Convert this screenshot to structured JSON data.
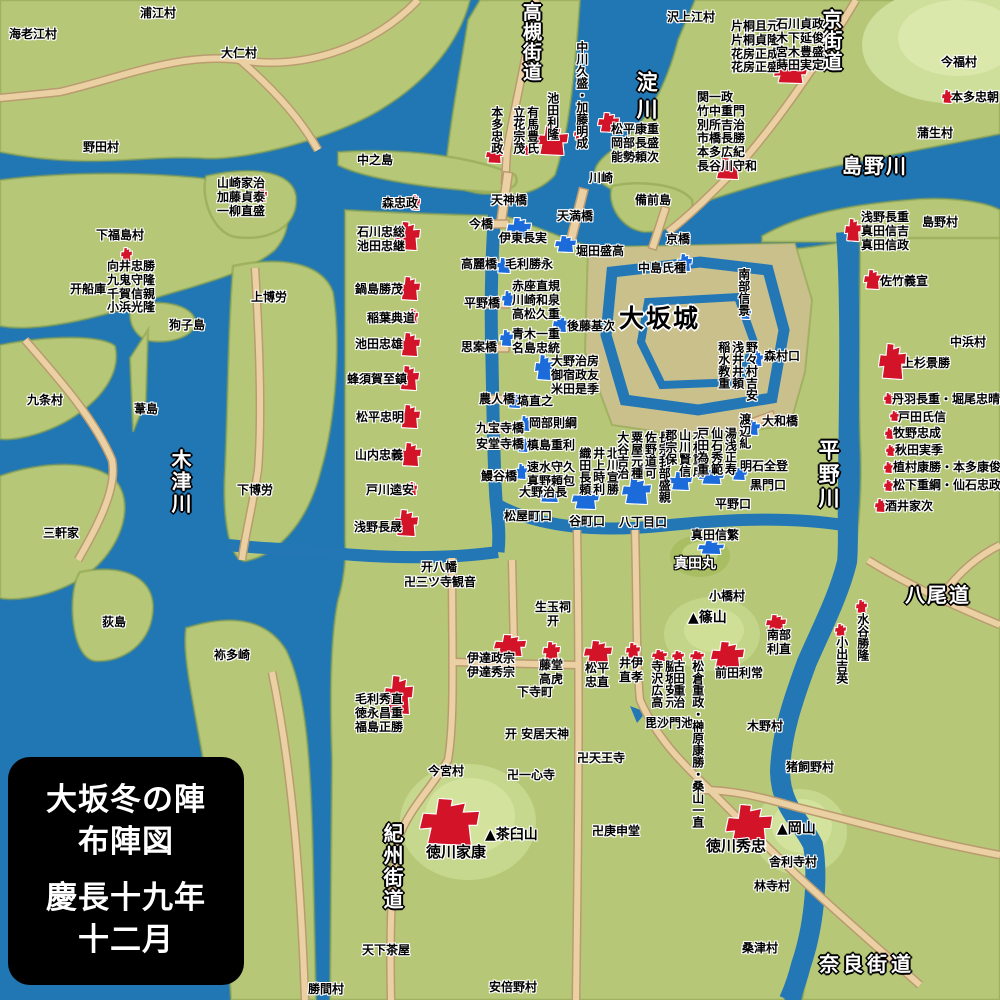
{
  "legend": {
    "l1": "大坂冬の陣",
    "l2": "布陣図",
    "l3": "慶長十九年",
    "l4": "十二月"
  },
  "colors": {
    "east_red": "#d31428",
    "west_blue": "#1b6bdb",
    "water": "#2176b4",
    "land": "#b6c878",
    "road": "#ead0a2",
    "hill": "#cede9b"
  },
  "map": {
    "big_labels": [
      {
        "t": "高槻街道",
        "x": 519,
        "y": 2,
        "v": 1,
        "fs": 19,
        "ls": 1
      },
      {
        "t": "淀川",
        "x": 634,
        "y": 71,
        "v": 1,
        "fs": 21,
        "ls": 6
      },
      {
        "t": "京街道",
        "x": 819,
        "y": 9,
        "v": 1,
        "fs": 20,
        "ls": 1
      },
      {
        "t": "島野川",
        "x": 842,
        "y": 155,
        "fs": 20,
        "ls": 2
      },
      {
        "t": "木津川",
        "x": 168,
        "y": 449,
        "v": 1,
        "fs": 20,
        "ls": 2
      },
      {
        "t": "平野川",
        "x": 816,
        "y": 439,
        "v": 1,
        "fs": 21,
        "ls": 3
      },
      {
        "t": "八尾道",
        "x": 905,
        "y": 584,
        "fs": 20,
        "ls": 2
      },
      {
        "t": "紀州街道",
        "x": 380,
        "y": 823,
        "v": 1,
        "fs": 20,
        "ls": 2
      },
      {
        "t": "奈良街道",
        "x": 819,
        "y": 953,
        "fs": 20,
        "ls": 4
      }
    ],
    "castle_label": {
      "t": "大坂城",
      "x": 619,
      "y": 305,
      "fs": 25,
      "ls": 2
    },
    "sanada_label": {
      "t": "真田丸",
      "x": 674,
      "y": 556
    },
    "villages": [
      {
        "t": "浦江村",
        "x": 140,
        "y": 7
      },
      {
        "t": "海老江村",
        "x": 9,
        "y": 28
      },
      {
        "t": "大仁村",
        "x": 221,
        "y": 47
      },
      {
        "t": "野田村",
        "x": 83,
        "y": 141
      },
      {
        "t": "中之島",
        "x": 357,
        "y": 154
      },
      {
        "t": "下福島村",
        "x": 96,
        "y": 229
      },
      {
        "t": "上博労",
        "x": 251,
        "y": 291
      },
      {
        "t": "狗子島",
        "x": 169,
        "y": 319
      },
      {
        "t": "九条村",
        "x": 27,
        "y": 394
      },
      {
        "t": "葦島",
        "x": 134,
        "y": 403
      },
      {
        "t": "下博労",
        "x": 237,
        "y": 484
      },
      {
        "t": "三軒家",
        "x": 43,
        "y": 527
      },
      {
        "t": "荻島",
        "x": 102,
        "y": 616
      },
      {
        "t": "袮多崎",
        "x": 214,
        "y": 649
      },
      {
        "t": "川崎",
        "x": 589,
        "y": 172
      },
      {
        "t": "備前島",
        "x": 635,
        "y": 194
      },
      {
        "t": "沢上江村",
        "x": 667,
        "y": 11
      },
      {
        "t": "今福村",
        "x": 941,
        "y": 56
      },
      {
        "t": "蒲生村",
        "x": 917,
        "y": 127
      },
      {
        "t": "島野村",
        "x": 922,
        "y": 216
      },
      {
        "t": "中浜村",
        "x": 950,
        "y": 336
      },
      {
        "t": "小橋村",
        "x": 709,
        "y": 590
      },
      {
        "t": "木野村",
        "x": 747,
        "y": 720
      },
      {
        "t": "猪飼野村",
        "x": 786,
        "y": 761
      },
      {
        "t": "今宮村",
        "x": 428,
        "y": 765
      },
      {
        "t": "下寺町",
        "x": 517,
        "y": 686
      },
      {
        "t": "舎利寺村",
        "x": 769,
        "y": 856
      },
      {
        "t": "林寺村",
        "x": 754,
        "y": 880
      },
      {
        "t": "桑津村",
        "x": 742,
        "y": 942
      },
      {
        "t": "天下茶屋",
        "x": 362,
        "y": 944
      },
      {
        "t": "勝間村",
        "x": 308,
        "y": 983
      },
      {
        "t": "安倍野村",
        "x": 489,
        "y": 981
      }
    ],
    "bridges": [
      {
        "t": "天神橋",
        "x": 491,
        "y": 194
      },
      {
        "t": "今橋",
        "x": 469,
        "y": 218
      },
      {
        "t": "天満橋",
        "x": 557,
        "y": 210
      },
      {
        "t": "京橋",
        "x": 666,
        "y": 233
      },
      {
        "t": "高麗橋",
        "x": 461,
        "y": 258
      },
      {
        "t": "平野橋",
        "x": 464,
        "y": 297
      },
      {
        "t": "思案橋",
        "x": 461,
        "y": 341
      },
      {
        "t": "農人橋",
        "x": 479,
        "y": 393
      },
      {
        "t": "九宝寺橋",
        "x": 476,
        "y": 422
      },
      {
        "t": "安堂寺橋",
        "x": 476,
        "y": 438
      },
      {
        "t": "鰻谷橋",
        "x": 481,
        "y": 470
      },
      {
        "t": "大和橋",
        "x": 762,
        "y": 415
      }
    ],
    "gates": [
      {
        "t": "松屋町口",
        "x": 504,
        "y": 510
      },
      {
        "t": "谷町口",
        "x": 569,
        "y": 515
      },
      {
        "t": "八丁目口",
        "x": 619,
        "y": 516
      },
      {
        "t": "平野口",
        "x": 715,
        "y": 498
      },
      {
        "t": "黒門口",
        "x": 750,
        "y": 479
      },
      {
        "t": "森村口",
        "x": 764,
        "y": 350
      }
    ],
    "landmarks": [
      {
        "t": "开八幡",
        "x": 421,
        "y": 561
      },
      {
        "t": "卍三ツ寺観音",
        "x": 404,
        "y": 576
      },
      {
        "t": [
          "生玉祠",
          "　开"
        ],
        "x": 535,
        "y": 601
      },
      {
        "t": "开 安居天神",
        "x": 505,
        "y": 728
      },
      {
        "t": "卍天王寺",
        "x": 577,
        "y": 752
      },
      {
        "t": "卍一心寺",
        "x": 507,
        "y": 769
      },
      {
        "t": "卍庚申堂",
        "x": 592,
        "y": 825
      },
      {
        "t": "毘沙門池",
        "x": 645,
        "y": 717
      },
      {
        "t": "开船庫",
        "x": 70,
        "y": 283
      },
      {
        "t": "▲茶臼山",
        "x": 485,
        "y": 827,
        "c": "mtn"
      },
      {
        "t": "▲岡山",
        "x": 777,
        "y": 821,
        "c": "mtn"
      },
      {
        "t": "▲篠山",
        "x": 688,
        "y": 610,
        "c": "mtn"
      }
    ],
    "east_army": [
      {
        "t": [
          "山崎家治",
          "加藤貞泰",
          "一柳直盛"
        ],
        "x": 217,
        "y": 177,
        "m": [
          256,
          188,
          11,
          14
        ]
      },
      {
        "t": [
          "向井忠勝",
          "九鬼守隆",
          "千賀信親",
          "小浜光隆"
        ],
        "x": 107,
        "y": 260,
        "m": [
          121,
          248,
          11,
          13
        ]
      },
      {
        "t": [
          "森忠政"
        ],
        "x": 382,
        "y": 197,
        "m": [
          411,
          195,
          9,
          15
        ]
      },
      {
        "t": [
          "石川忠総",
          "池田忠継"
        ],
        "x": 357,
        "y": 226,
        "m": [
          395,
          222,
          25,
          28
        ]
      },
      {
        "t": [
          "鍋島勝茂"
        ],
        "x": 355,
        "y": 283,
        "m": [
          399,
          277,
          21,
          23
        ]
      },
      {
        "t": [
          "稲葉典道"
        ],
        "x": 367,
        "y": 312,
        "m": [
          408,
          309,
          10,
          14
        ]
      },
      {
        "t": [
          "池田忠雄"
        ],
        "x": 355,
        "y": 338,
        "m": [
          399,
          333,
          21,
          23
        ]
      },
      {
        "t": [
          "蜂須賀至鎮"
        ],
        "x": 347,
        "y": 373,
        "m": [
          398,
          366,
          21,
          24
        ]
      },
      {
        "t": [
          "松平忠明"
        ],
        "x": 356,
        "y": 411,
        "m": [
          399,
          405,
          21,
          23
        ]
      },
      {
        "t": [
          "山内忠義"
        ],
        "x": 355,
        "y": 449,
        "m": [
          400,
          443,
          21,
          23
        ]
      },
      {
        "t": [
          "戸川逵安"
        ],
        "x": 366,
        "y": 484,
        "m": [
          408,
          482,
          9,
          13
        ]
      },
      {
        "t": [
          "浅野長晟"
        ],
        "x": 354,
        "y": 521,
        "m": [
          394,
          510,
          24,
          26
        ]
      },
      {
        "t": [
          "本多忠政"
        ],
        "x": 489,
        "y": 106,
        "v": 1,
        "m": [
          486,
          147,
          17,
          16
        ]
      },
      {
        "t": [
          "有馬豊氏",
          "立花宗茂"
        ],
        "x": 511,
        "y": 106,
        "v": 1,
        "m": [
          519,
          144,
          11,
          11
        ]
      },
      {
        "t": [
          "池田利隆"
        ],
        "x": 545,
        "y": 92,
        "v": 1,
        "m": [
          536,
          126,
          32,
          29
        ]
      },
      {
        "t": [
          "中川久盛・加藤明成"
        ],
        "x": 574,
        "y": 41,
        "v": 1,
        "m": [
          574,
          128,
          12,
          12
        ]
      },
      {
        "t": [
          "松平康重",
          "岡部長盛",
          "能勢頼次"
        ],
        "x": 611,
        "y": 123,
        "m": [
          598,
          113,
          21,
          19
        ]
      },
      {
        "t": [
          "片桐且元",
          "片桐貞隆",
          "花房正成",
          "花房正盛"
        ],
        "x": 731,
        "y": 20
      },
      {
        "t": [
          "石川貞政",
          "木下延俊",
          "宮木豊盛",
          "蒔田実定"
        ],
        "x": 776,
        "y": 18,
        "m": [
          774,
          63,
          33,
          20
        ]
      },
      {
        "t": [
          "関一政",
          "竹中重門",
          "別所吉治",
          "市橋長勝",
          "本多広紀",
          "長谷川守和"
        ],
        "x": 697,
        "y": 91,
        "m": [
          713,
          158,
          29,
          21
        ]
      },
      {
        "t": [
          "本多忠朝"
        ],
        "x": 951,
        "y": 91,
        "m": [
          942,
          90,
          11,
          13
        ]
      },
      {
        "t": [
          "浅野長重",
          "真田信吉",
          "真田信政"
        ],
        "x": 861,
        "y": 211,
        "m": [
          845,
          219,
          16,
          22
        ]
      },
      {
        "t": [
          "佐竹義宣"
        ],
        "x": 880,
        "y": 275,
        "m": [
          864,
          270,
          17,
          19
        ]
      },
      {
        "t": [
          "上杉景勝"
        ],
        "x": 902,
        "y": 357,
        "m": [
          879,
          344,
          27,
          35
        ]
      },
      {
        "t": [
          "丹羽長重・堀尾忠晴"
        ],
        "x": 892,
        "y": 393,
        "m": [
          884,
          393,
          9,
          11
        ]
      },
      {
        "t": [
          "戸田氏信"
        ],
        "x": 898,
        "y": 411,
        "m": [
          890,
          411,
          9,
          10
        ]
      },
      {
        "t": [
          "牧野忠成"
        ],
        "x": 893,
        "y": 427,
        "m": [
          885,
          428,
          9,
          11
        ]
      },
      {
        "t": [
          "秋田実季"
        ],
        "x": 895,
        "y": 444,
        "m": [
          886,
          445,
          9,
          11
        ]
      },
      {
        "t": [
          "植村康勝・本多康俊"
        ],
        "x": 893,
        "y": 461,
        "m": [
          884,
          462,
          9,
          11
        ]
      },
      {
        "t": [
          "松下重綱・仙石忠政"
        ],
        "x": 893,
        "y": 479,
        "m": [
          884,
          480,
          9,
          11
        ]
      },
      {
        "t": [
          "酒井家次"
        ],
        "x": 885,
        "y": 500,
        "m": [
          875,
          499,
          11,
          13
        ]
      },
      {
        "t": [
          "毛利秀直",
          "徳永昌重",
          "福島正勝"
        ],
        "x": 355,
        "y": 693,
        "m": [
          384,
          676,
          29,
          38
        ]
      },
      {
        "t": [
          "伊達政宗",
          "伊達秀宗"
        ],
        "x": 467,
        "y": 652,
        "m": [
          494,
          635,
          32,
          21
        ]
      },
      {
        "t": [
          "藤堂",
          "高虎"
        ],
        "x": 539,
        "y": 659,
        "m": [
          543,
          642,
          17,
          18
        ]
      },
      {
        "t": [
          "松平",
          "忠直"
        ],
        "x": 585,
        "y": 662,
        "m": [
          584,
          641,
          28,
          23
        ]
      },
      {
        "t": [
          "井伊",
          "直孝"
        ],
        "x": 619,
        "y": 657,
        "m": [
          626,
          643,
          14,
          15
        ]
      },
      {
        "t": [
          "脇坂安元",
          "寺沢広高"
        ],
        "x": 649,
        "y": 660,
        "v": 1,
        "m": [
          652,
          650,
          15,
          11
        ]
      },
      {
        "t": [
          "古田重治"
        ],
        "x": 671,
        "y": 660,
        "v": 1,
        "m": [
          672,
          651,
          12,
          10
        ]
      },
      {
        "t": [
          "松倉重政・榊原康勝・桑山一直"
        ],
        "x": 690,
        "y": 660,
        "v": 1,
        "m": [
          690,
          651,
          14,
          10
        ]
      },
      {
        "t": [
          "前田利常"
        ],
        "x": 715,
        "y": 667,
        "m": [
          711,
          642,
          33,
          27
        ]
      },
      {
        "t": [
          "南部",
          "利直"
        ],
        "x": 767,
        "y": 629,
        "m": [
          766,
          615,
          20,
          16
        ]
      },
      {
        "t": [
          "水谷勝隆"
        ],
        "x": 855,
        "y": 613,
        "v": 1,
        "m": [
          856,
          600,
          11,
          13
        ]
      },
      {
        "t": [
          "小出吉英"
        ],
        "x": 834,
        "y": 636,
        "v": 1,
        "m": [
          835,
          624,
          11,
          12
        ]
      },
      {
        "t": [
          "徳川家康"
        ],
        "x": 426,
        "y": 844,
        "fs": 15,
        "m": [
          420,
          799,
          59,
          46
        ]
      },
      {
        "t": [
          "徳川秀忠"
        ],
        "x": 706,
        "y": 838,
        "fs": 15,
        "m": [
          726,
          805,
          46,
          41
        ]
      }
    ],
    "west_army": [
      {
        "t": [
          "伊東長実"
        ],
        "x": 499,
        "y": 232,
        "m": [
          507,
          218,
          24,
          20
        ]
      },
      {
        "t": [
          "堀田盛高"
        ],
        "x": 576,
        "y": 245,
        "m": [
          555,
          236,
          21,
          16
        ]
      },
      {
        "t": [
          "中島氏種"
        ],
        "x": 638,
        "y": 262,
        "m": [
          677,
          254,
          15,
          17
        ]
      },
      {
        "t": [
          "毛利勝永"
        ],
        "x": 505,
        "y": 258,
        "m": [
          496,
          258,
          16,
          15
        ]
      },
      {
        "t": [
          "赤座直規",
          "川崎和泉",
          "高松久重"
        ],
        "x": 512,
        "y": 280,
        "m": [
          502,
          291,
          12,
          15
        ]
      },
      {
        "t": [
          "青木一重",
          "名島忠統"
        ],
        "x": 512,
        "y": 328,
        "m": [
          500,
          330,
          13,
          16
        ]
      },
      {
        "t": [
          "後藤基次"
        ],
        "x": 567,
        "y": 320,
        "m": [
          553,
          316,
          15,
          16
        ]
      },
      {
        "t": [
          "大野治房",
          "御宿政友",
          "米田是季"
        ],
        "x": 551,
        "y": 355,
        "m": [
          535,
          355,
          18,
          25
        ]
      },
      {
        "t": [
          "塙直之"
        ],
        "x": 517,
        "y": 395,
        "m": [
          507,
          393,
          15,
          15
        ]
      },
      {
        "t": [
          "岡部則綱"
        ],
        "x": 529,
        "y": 417,
        "m": [
          519,
          416,
          12,
          15
        ]
      },
      {
        "t": [
          "槙島重利"
        ],
        "x": 527,
        "y": 439,
        "m": [
          517,
          437,
          12,
          15
        ]
      },
      {
        "t": [
          "速水守久",
          "真野頼包"
        ],
        "x": 527,
        "y": 461,
        "m": [
          516,
          464,
          11,
          15
        ]
      },
      {
        "t": [
          "大野治長"
        ],
        "x": 519,
        "y": 486,
        "m": [
          538,
          490,
          23,
          12
        ]
      },
      {
        "t": [
          "北川宣勝",
          "井上時利",
          "織田長頼"
        ],
        "x": 577,
        "y": 447,
        "v": 1,
        "m": [
          572,
          489,
          27,
          20
        ]
      },
      {
        "t": [
          "長宗我部盛親",
          "佐野道可",
          "粟屋元種",
          "大谷吉治"
        ],
        "x": 615,
        "y": 431,
        "v": 1,
        "m": [
          622,
          478,
          29,
          26
        ]
      },
      {
        "t": [
          "木村重成",
          "山川賢信",
          "郡宗保"
        ],
        "x": 663,
        "y": 429,
        "v": 1,
        "m": [
          669,
          472,
          23,
          18
        ]
      },
      {
        "t": [
          "湯浅正寿",
          "仙石秀範",
          "戸田為重"
        ],
        "x": 695,
        "y": 427,
        "v": 1,
        "m": [
          699,
          470,
          25,
          14
        ]
      },
      {
        "t": [
          "渡辺糺"
        ],
        "x": 737,
        "y": 413,
        "v": 1,
        "m": [
          744,
          420,
          16,
          15
        ]
      },
      {
        "t": [
          "明石全登"
        ],
        "x": 740,
        "y": 460,
        "m": [
          731,
          468,
          16,
          12
        ]
      },
      {
        "t": [
          "南部信景"
        ],
        "x": 736,
        "y": 268,
        "v": 1,
        "m": [
          740,
          307,
          11,
          12
        ]
      },
      {
        "t": [
          "野々村吉安",
          "浅井井頼",
          "稲水教重"
        ],
        "x": 716,
        "y": 341,
        "v": 1,
        "m": [
          752,
          351,
          11,
          15
        ]
      },
      {
        "t": [
          "真田信繁"
        ],
        "x": 691,
        "y": 529,
        "m": [
          698,
          541,
          26,
          13
        ]
      }
    ]
  }
}
